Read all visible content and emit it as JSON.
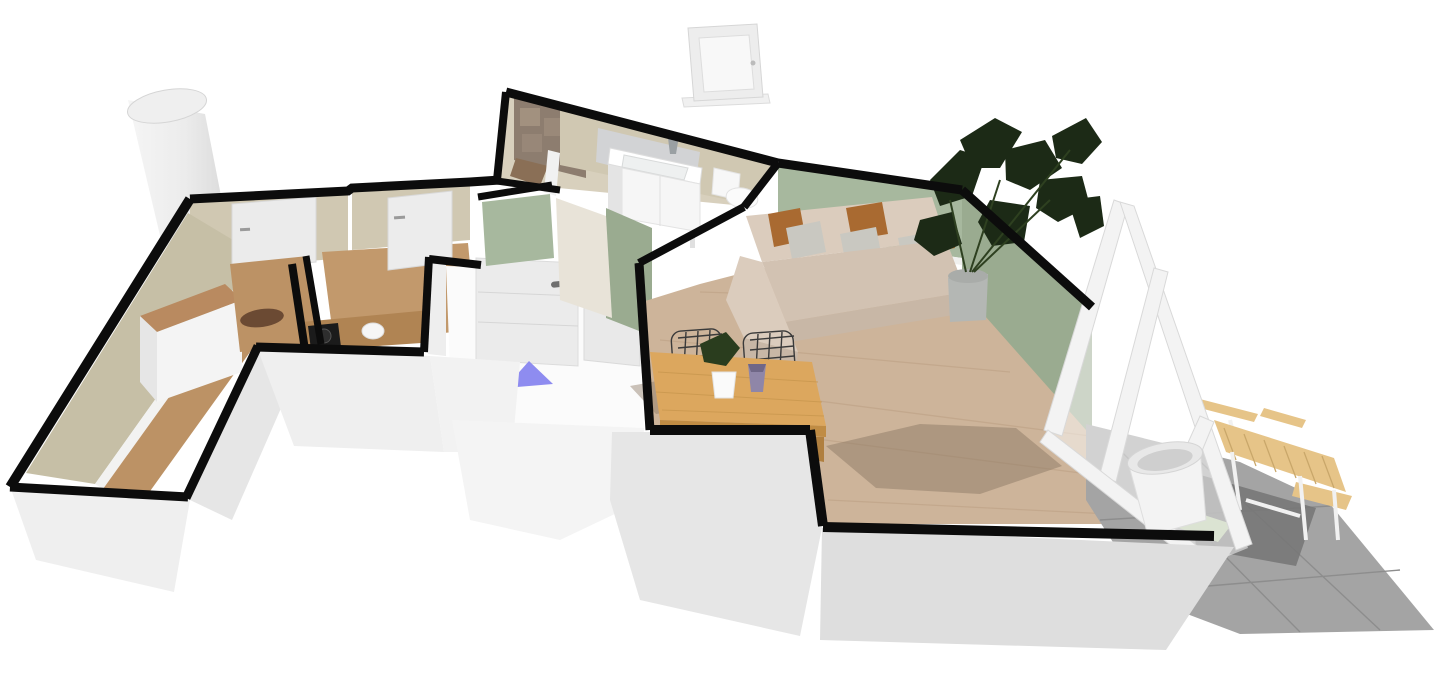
{
  "viewport": {
    "type": "floor-plan-3d-render",
    "background": "#ffffff"
  },
  "marker": {
    "kind": "entrance-direction-triangle",
    "color": "#8e8cf0"
  },
  "colors": {
    "background": "#ffffff",
    "wall_outline": "#0c0c0c",
    "wall_green": "#a7b89e",
    "wall_green_shaded": "#9aab90",
    "wall_beige": "#d0c8b2",
    "backsplash_gray": "#d2d3d5",
    "shower_tile_dark": "#8d7d6f",
    "shower_tile_light": "#a69482",
    "floor_tan": "#c6bfa6",
    "floor_wood_hall": "#bc9265",
    "floor_wood_living": "#cdb49a",
    "plank_line": "#bfa283",
    "floor_shadow": "#8d7a66",
    "table_wood": "#dca75e",
    "table_wood_dark": "#c08c44",
    "counter_wood": "#b08453",
    "dresser_wood": "#b98a60",
    "sofa_base": "#dbccbd",
    "sofa_seat": "#d2c2b2",
    "sofa_front": "#c8b7a6",
    "pillow_rust": "#a96a31",
    "pillow_gray": "#c9c8c1",
    "plant_dark": "#1c2a16",
    "plant_mid": "#2a3d1e",
    "pot_gray": "#b4b7b4",
    "marker_blue": "#8e8cf0",
    "glass_frame": "#f3f3f3",
    "terrace_tile": "#a4a4a4",
    "terrace_shadow": "#757575",
    "grass_green": "#b7c7a4",
    "outdoor_wood": "#e6c488",
    "outdoor_wood_line": "#c9a76a",
    "slab_light": "#efefef",
    "slab_mid": "#e6e6e6",
    "slab_dark": "#dedede",
    "entry_floor": "#fbfbfb",
    "fixture_white": "#f6f6f6",
    "cooktop_black": "#1b1b1b"
  },
  "rooms_depicted": [
    "bedroom-left-wing",
    "small-bedroom",
    "kitchen",
    "entry-hall",
    "bathroom",
    "living-room",
    "dining-area",
    "terrace"
  ],
  "objects_depicted": [
    "chimney",
    "floating-wall-cabinet",
    "dresser",
    "wardrobe",
    "front-door",
    "interior-doors",
    "kitchen-counter",
    "cooktop",
    "bathroom-vanity",
    "faucet",
    "toilet",
    "shower-tile-wall",
    "sectional-sofa",
    "pillows",
    "monstera-plants",
    "dining-table",
    "wire-chairs",
    "table-plant",
    "purple-vase",
    "entrance-marker",
    "glass-sliding-wall",
    "terrace-tiles",
    "outdoor-table",
    "outdoor-chairs",
    "planter-pot",
    "grass-patch"
  ]
}
